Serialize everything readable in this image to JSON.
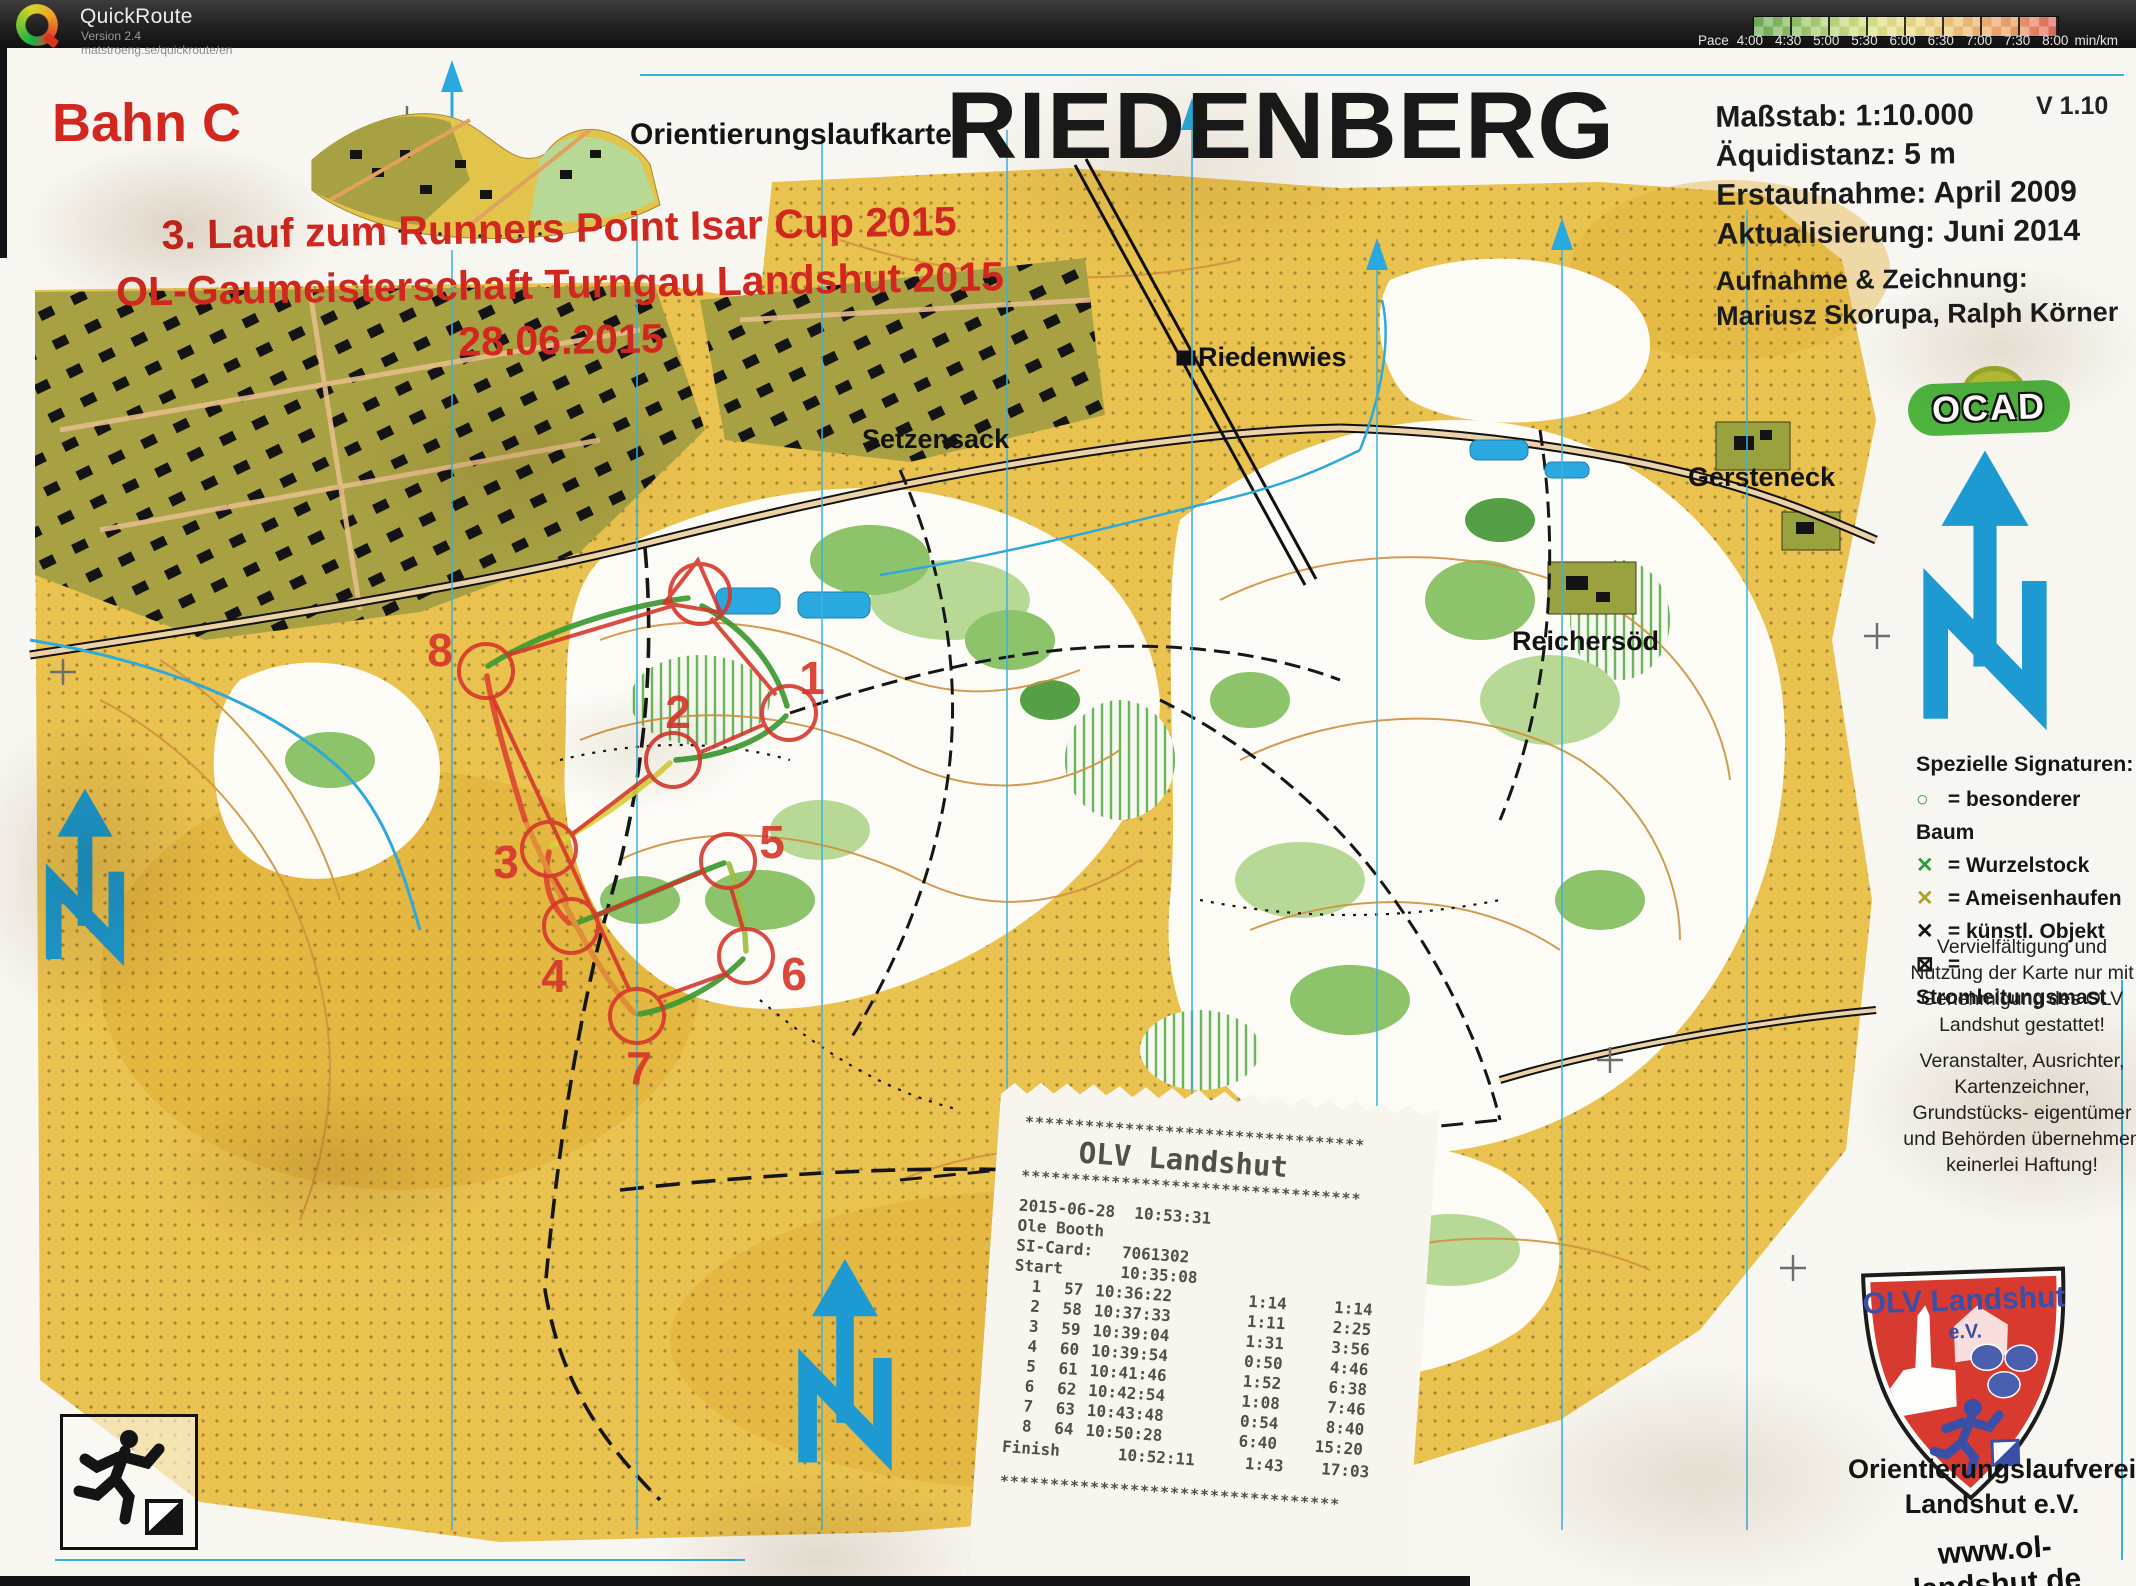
{
  "titlebar": {
    "app_name": "QuickRoute",
    "version": "Version 2.4",
    "url": "matstroeng.se/quickroute/en",
    "pace_label": "Pace",
    "pace_unit": "min/km",
    "pace_ticks": [
      "4:00",
      "4:30",
      "5:00",
      "5:30",
      "6:00",
      "6:30",
      "7:00",
      "7:30",
      "8:00"
    ]
  },
  "map": {
    "course_label": "Bahn C",
    "map_kind": "Orientierungslaufkarte",
    "title": "RIEDENBERG",
    "version": "V 1.10",
    "meta": {
      "scale": "Maßstab: 1:10.000",
      "equidistance": "Äquidistanz: 5 m",
      "first_survey": "Erstaufnahme: April 2009",
      "update": "Aktualisierung: Juni 2014",
      "credit_heading": "Aufnahme & Zeichnung:",
      "credit_names": "Mariusz Skorupa, Ralph Körner"
    },
    "event_lines": [
      "3. Lauf zum Runners Point Isar Cup 2015",
      "OL-Gaumeisterschaft Turngau Landshut 2015",
      "28.06.2015"
    ],
    "places": [
      "Setzensack",
      "Riedenwies",
      "Gersteneck",
      "Reichersöd"
    ],
    "ocad_label": "OCAD",
    "legend": {
      "heading": "Spezielle Signaturen:",
      "items": [
        {
          "sym": "○",
          "cls": "g",
          "text": "= besonderer Baum"
        },
        {
          "sym": "✕",
          "cls": "g",
          "text": "= Wurzelstock"
        },
        {
          "sym": "✕",
          "cls": "o",
          "text": "= Ameisenhaufen"
        },
        {
          "sym": "✕",
          "cls": "k",
          "text": "= künstl. Objekt"
        },
        {
          "sym": "⊠",
          "cls": "k",
          "text": "= Stromleitungsmast"
        }
      ]
    },
    "notices": [
      "Vervielfältigung und Nutzung der Karte nur mit Genehmigung des OLV Landshut gestattet!",
      "Veranstalter, Ausrichter, Kartenzeichner, Grundstücks- eigentümer und Behörden übernehmen keinerlei Haftung!"
    ],
    "club": {
      "shield_name": "OLV Landshut",
      "shield_ev": "e.V.",
      "org_line1": "Orientierungslaufverein",
      "org_line2": "Landshut e.V.",
      "website": "www.ol-landshut.de"
    },
    "course_numbers": [
      "1",
      "2",
      "3",
      "4",
      "5",
      "6",
      "7",
      "8"
    ],
    "colors": {
      "course_red": "#d6342a",
      "open_yellow": "#eac24f",
      "north_blue": "#1d9ad2"
    }
  },
  "control_card": {
    "title": "3. RPC 2015",
    "course": "Bahn C",
    "length": "2,0 km",
    "climb": "35 m",
    "start_symbol": "▷",
    "start_label": "Start:",
    "rows": [
      {
        "num": "1",
        "code": "57",
        "desc": "Pfad - Gabelung"
      },
      {
        "num": "2",
        "code": "58",
        "desc": "Pfad - Gabelung"
      },
      {
        "num": "3",
        "code": "59",
        "desc": "Pfad - Kreuzung"
      },
      {
        "num": "4",
        "code": "60",
        "desc": "Einzelbaum"
      },
      {
        "num": "5",
        "code": "61",
        "desc": "Pfad - Kreuzung"
      },
      {
        "num": "6",
        "code": "62",
        "desc": "Pfad - Gabelung"
      },
      {
        "num": "7",
        "code": "63",
        "desc": "Pfad - Gabelung"
      },
      {
        "num": "8",
        "code": "64",
        "desc": "Pfad - Kreuzung"
      }
    ],
    "footer": "290 m zum Ziel"
  },
  "receipt": {
    "stars": "**********************************",
    "title": "OLV Landshut",
    "datetime": "2015-06-28  10:53:31",
    "runner": "Ole Booth",
    "card_line": "SI-Card:   7061302",
    "start_line": "Start      10:35:08",
    "splits": [
      {
        "num": "1",
        "code": "57",
        "time": "10:36:22",
        "leg": "1:14",
        "total": "1:14"
      },
      {
        "num": "2",
        "code": "58",
        "time": "10:37:33",
        "leg": "1:11",
        "total": "2:25"
      },
      {
        "num": "3",
        "code": "59",
        "time": "10:39:04",
        "leg": "1:31",
        "total": "3:56"
      },
      {
        "num": "4",
        "code": "60",
        "time": "10:39:54",
        "leg": "0:50",
        "total": "4:46"
      },
      {
        "num": "5",
        "code": "61",
        "time": "10:41:46",
        "leg": "1:52",
        "total": "6:38"
      },
      {
        "num": "6",
        "code": "62",
        "time": "10:42:54",
        "leg": "1:08",
        "total": "7:46"
      },
      {
        "num": "7",
        "code": "63",
        "time": "10:43:48",
        "leg": "0:54",
        "total": "8:40"
      },
      {
        "num": "8",
        "code": "64",
        "time": "10:50:28",
        "leg": "6:40",
        "total": "15:20"
      }
    ],
    "finish_label": "Finish",
    "finish_time": "10:52:11",
    "finish_leg": "1:43",
    "finish_total": "17:03"
  }
}
